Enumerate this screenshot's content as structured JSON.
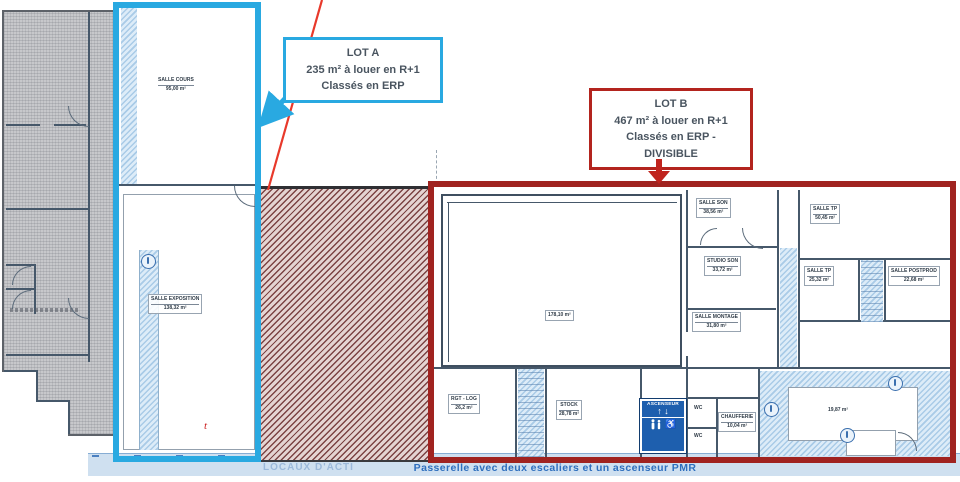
{
  "callouts": {
    "lot_a": {
      "title": "LOT A",
      "line1": "235 m² à louer en R+1",
      "line2": "Classés en ERP"
    },
    "lot_b": {
      "title": "LOT B",
      "line1": "467 m² à louer en R+1",
      "line2": "Classés en ERP -",
      "line3": "DIVISIBLE"
    }
  },
  "footer": {
    "caption": "Passerelle avec deux escaliers et un ascenseur PMR",
    "watermark": "LOCAUX D'ACTI"
  },
  "elevator": {
    "label": "ASCENSEUR",
    "up_arrow": "↑",
    "down_arrow": "↓",
    "wheelchair_icon": "♿"
  },
  "annotations": {
    "t_mark": "t"
  },
  "rooms": {
    "salle_cours": {
      "name": "SALLE COURS",
      "area": "95,00 m²"
    },
    "salle_exposition": {
      "name": "SALLE EXPOSITION",
      "area": "138,32 m²"
    },
    "grande_salle": {
      "area": "178,10 m²"
    },
    "salle_son": {
      "name": "SALLE SON",
      "area": "38,56 m²"
    },
    "salle_tp_grande": {
      "name": "SALLE TP",
      "area": "50,45 m²"
    },
    "studio_son": {
      "name": "STUDIO SON",
      "area": "33,72 m²"
    },
    "salle_tp_petite": {
      "name": "SALLE TP",
      "area": "25,32 m²"
    },
    "salle_postprod": {
      "name": "SALLE POSTPROD",
      "area": "22,68 m²"
    },
    "salle_montage": {
      "name": "SALLE MONTAGE",
      "area": "31,80 m²"
    },
    "rgt_log": {
      "name": "RGT - LOG",
      "area": "26,2 m²"
    },
    "stock": {
      "name": "STOCK",
      "area": "28,78 m²"
    },
    "wc": {
      "name": "WC"
    },
    "chaufferie": {
      "name": "CHAUFFERIE",
      "area": "10,04 m²"
    },
    "salle_droite": {
      "area": "19,87 m²"
    }
  },
  "colors": {
    "lot_a_blue": "#29a9e1",
    "lot_b_red": "#a02320",
    "arrow_red": "#cf2b20",
    "hatch_line": "#7c4343",
    "plan_line": "#46586a",
    "light_blue_fill": "#cfe2f2",
    "caption_blue": "#2e6fbe",
    "elevator_blue": "#1e5fae"
  }
}
